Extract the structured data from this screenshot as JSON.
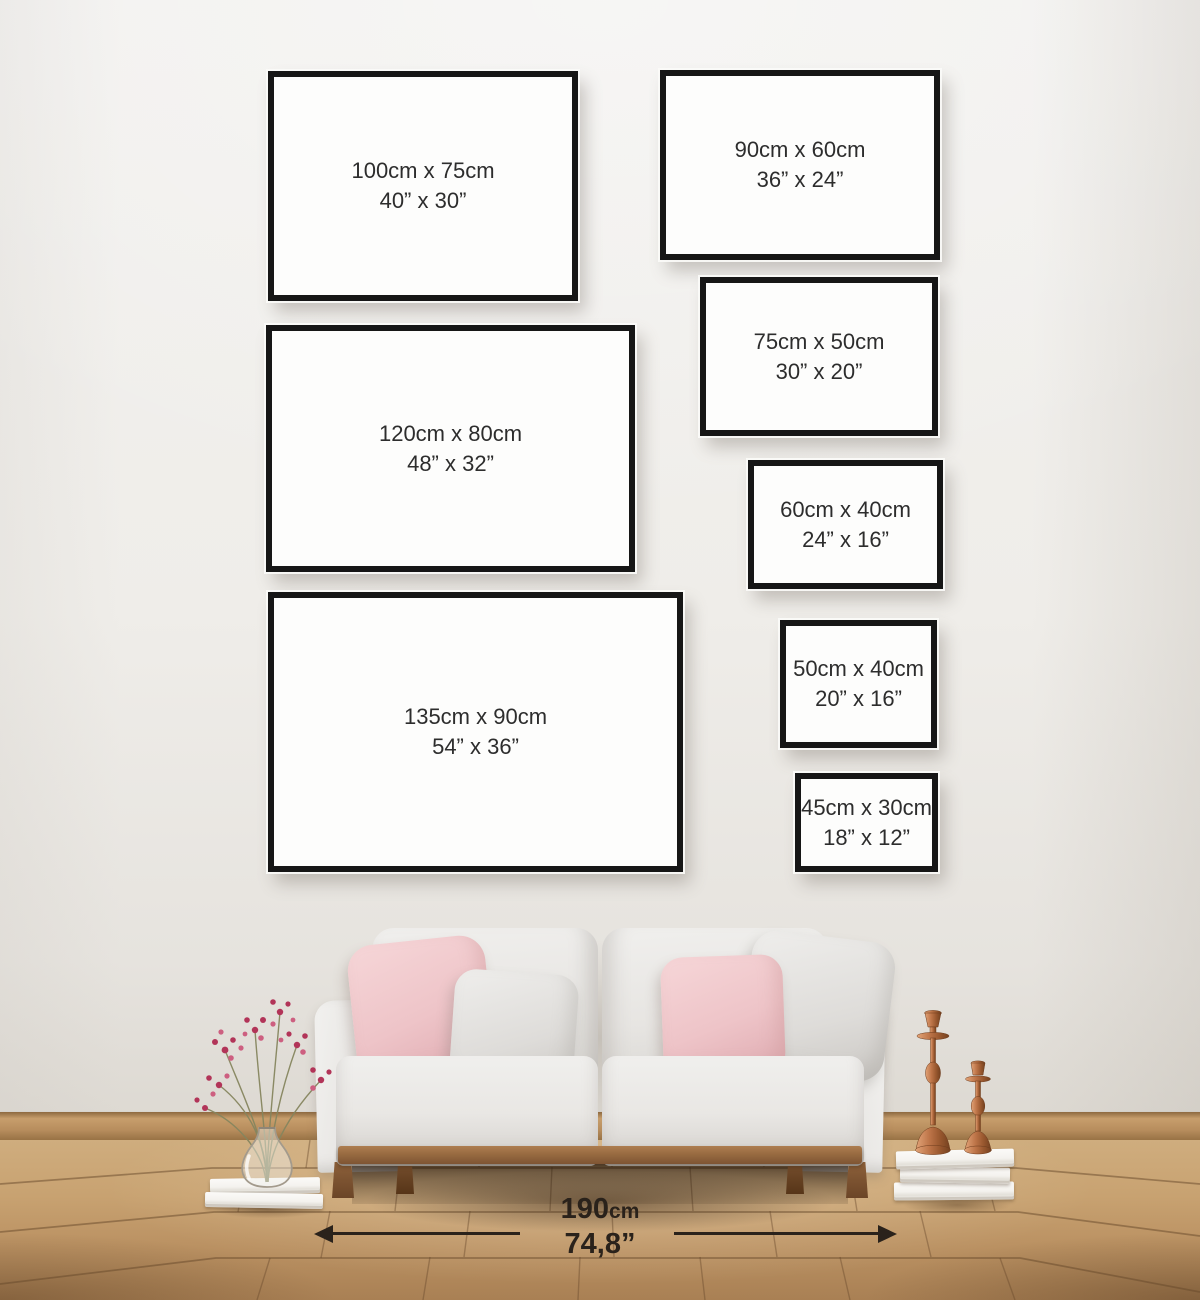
{
  "frames": [
    {
      "cm": "100cm x 75cm",
      "inches": "40” x 30”"
    },
    {
      "cm": "120cm x 80cm",
      "inches": "48” x 32”"
    },
    {
      "cm": "135cm x 90cm",
      "inches": "54” x 36”"
    },
    {
      "cm": "90cm x 60cm",
      "inches": "36” x 24”"
    },
    {
      "cm": "75cm x 50cm",
      "inches": "30” x 20”"
    },
    {
      "cm": "60cm x 40cm",
      "inches": "24” x 16”"
    },
    {
      "cm": "50cm x 40cm",
      "inches": "20” x 16”"
    },
    {
      "cm": "45cm x 30cm",
      "inches": "18” x 12”"
    }
  ],
  "floor_measurement": {
    "value": "190",
    "unit": "cm",
    "inches": "74,8”"
  },
  "colors": {
    "wall": "#f1efec",
    "frame_border": "#161616",
    "frame_face": "#fdfdfc",
    "label_text": "#2d2d2d",
    "measurement_text": "#2a221b",
    "floor_wood": "#c49a6c",
    "baseboard_wood": "#ab7f51",
    "sofa_fabric": "#e9e8e5",
    "sofa_wood": "#9a6b41",
    "pillow_pink": "#efc5c9",
    "pillow_gray": "#dedcd9",
    "candlestick_copper": "#b5724a",
    "flower_pink": "#c2406a",
    "book_white": "#f6f5f2"
  }
}
